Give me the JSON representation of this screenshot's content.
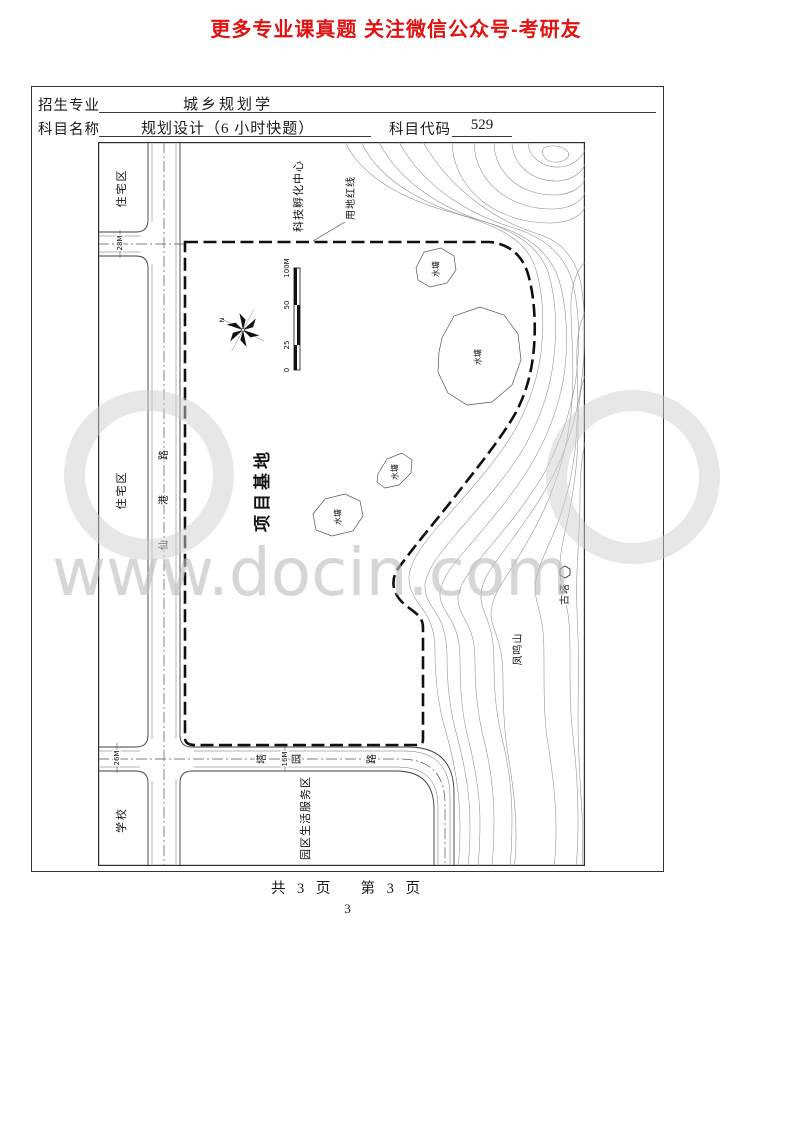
{
  "header": {
    "promo": "更多专业课真题 关注微信公众号-考研友"
  },
  "form": {
    "major_label": "招生专业",
    "major_value": "城乡规划学",
    "subject_label": "科目名称",
    "subject_value": "规划设计（6 小时快题）",
    "code_label": "科目代码",
    "code_value": "529"
  },
  "map": {
    "zones": {
      "residential_top": "住宅区",
      "residential_mid": "住宅区",
      "school": "学校",
      "service_area": "园区生活服务区",
      "incubator": "科技孵化中心",
      "site": "项目基地"
    },
    "boundary_label": "用地红线",
    "pond_label": "水塘",
    "roads": {
      "v_chars": [
        "仙",
        "港",
        "路"
      ],
      "h_chars": [
        "塔",
        "园",
        "路"
      ],
      "w_top": "28M",
      "w_left": "26M",
      "w_bottom": "16M"
    },
    "features": {
      "mountain": "凤鸣山",
      "pagoda": "古塔"
    },
    "compass_n": "N",
    "scale": {
      "labels": [
        "0",
        "25",
        "50",
        "100M"
      ]
    }
  },
  "watermark": {
    "text": "www.docin.com"
  },
  "footer": {
    "pages": "共 3 页　 第 3 页",
    "page_number": "3"
  }
}
